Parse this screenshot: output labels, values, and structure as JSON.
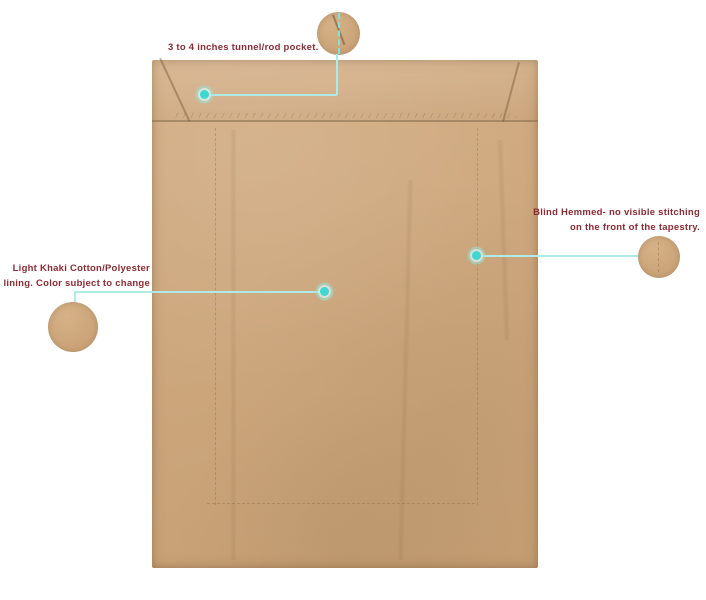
{
  "callouts": {
    "rod_pocket": {
      "text": "3 to 4 inches tunnel/rod pocket."
    },
    "blind_hem": {
      "line1": "Blind Hemmed- no visible stitching",
      "line2": "on the front of the tapestry."
    },
    "lining": {
      "line1": "Light Khaki Cotton/Polyester",
      "line2": "lining. Color subject to change"
    }
  },
  "colors": {
    "annotation_text": "#8e2a34",
    "leader_line": "#aeebe7",
    "hotspot_dot": "#3ed7d1",
    "fabric_khaki": "#cca77d",
    "background": "#ffffff"
  }
}
